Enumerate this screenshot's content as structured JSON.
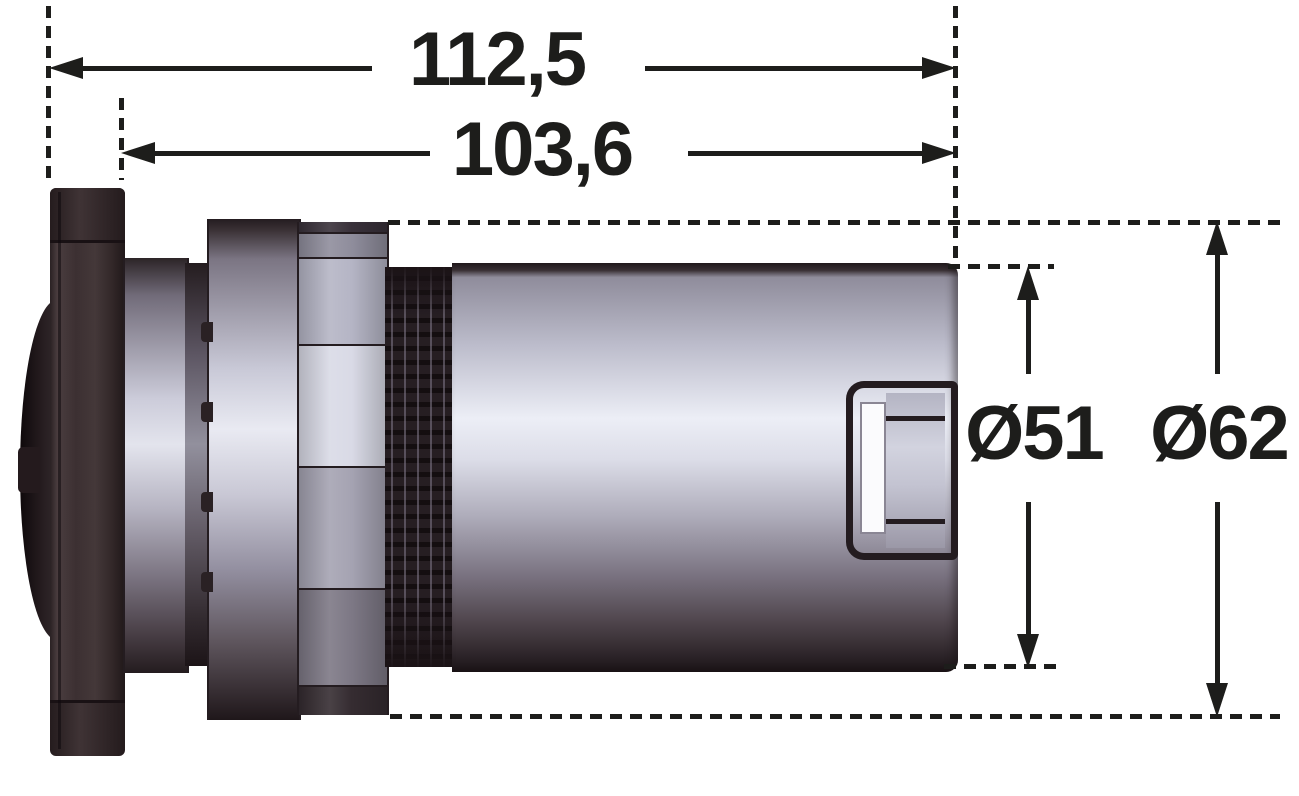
{
  "drawing": {
    "description": "Side-view technical drawing of cylindrical lamp housing with flange, hex nut, thread and body, annotated with four dimensions",
    "dimensions": {
      "overall_length": {
        "label": "112,5"
      },
      "housing_length": {
        "label": "103,6"
      },
      "body_diameter": {
        "label": "Ø51"
      },
      "nut_diameter": {
        "label": "Ø62"
      }
    },
    "colors": {
      "line": "#1d1d1b",
      "background": "#ffffff",
      "edge_dark": "#241c20",
      "metal_highlight": "#eceef6",
      "metal_mid": "#a8a6b4",
      "metal_shadow": "#453b42",
      "housing_dark": "#3a2e30",
      "threads_dark": "#1a1215",
      "slot_white": "#fbfbfd"
    }
  }
}
